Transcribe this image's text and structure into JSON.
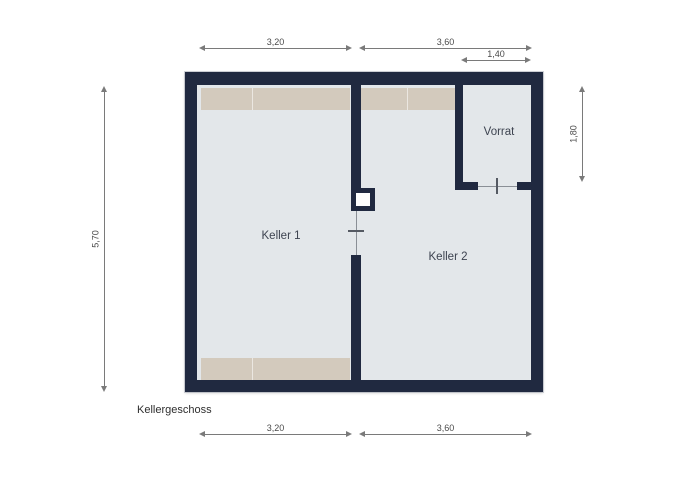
{
  "title": "Kellergeschoss",
  "rooms": [
    {
      "name": "Keller 1"
    },
    {
      "name": "Keller 2"
    },
    {
      "name": "Vorrat"
    }
  ],
  "dimensions": {
    "top_left_width": "3,20",
    "top_right_width": "3,60",
    "vorrat_width": "1,40",
    "left_height": "5,70",
    "vorrat_height": "1,80",
    "bottom_left_width": "3,20",
    "bottom_right_width": "3,60"
  },
  "colors": {
    "wall": "#202940",
    "floor": "#e3e7ea",
    "shelf": "#d3cabd",
    "dimension_line": "#7a7a7a",
    "dimension_text": "#4a4a4a",
    "label_text": "#3d4350"
  }
}
